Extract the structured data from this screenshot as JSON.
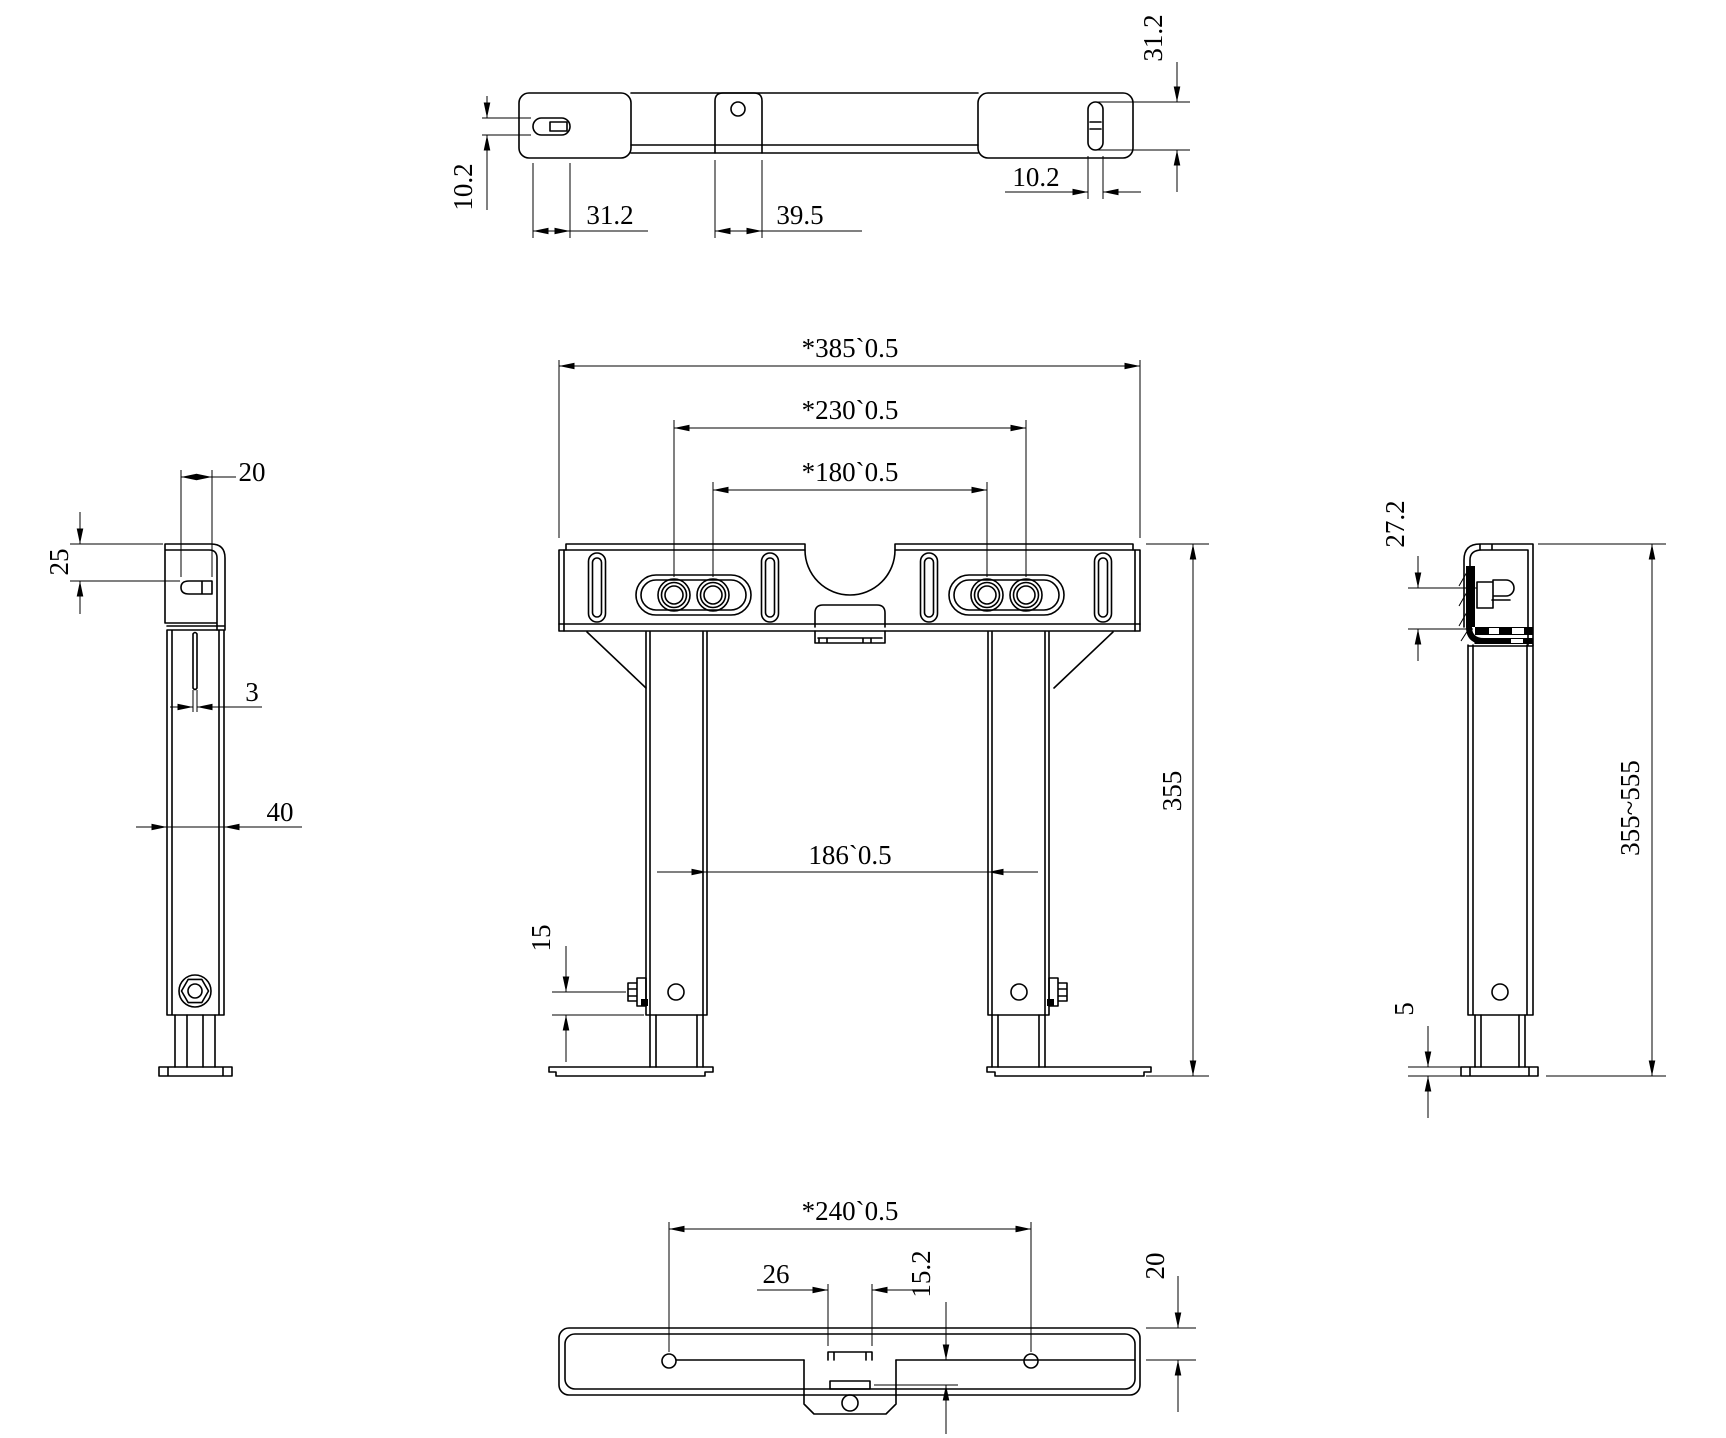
{
  "meta": {
    "background": "#ffffff",
    "line_color": "#000000"
  },
  "views": {
    "top": {
      "dims": {
        "slot_height_left": "10.2",
        "slot_length_left": "31.2",
        "tab_width": "39.5",
        "slot_width_right": "10.2",
        "slot_length_right": "31.2"
      }
    },
    "front": {
      "dims": {
        "overall_width": "*385`0.5",
        "hole_span_outer": "*230`0.5",
        "hole_span_inner": "*180`0.5",
        "leg_gap": "186`0.5",
        "bolt_offset": "15",
        "height": "355"
      }
    },
    "left": {
      "dims": {
        "slot_length": "20",
        "slot_offset": "25",
        "slot_width": "3",
        "leg_width": "40"
      }
    },
    "right": {
      "dims": {
        "bracket_depth": "27.2",
        "height_range": "355~555",
        "foot_thickness": "5"
      }
    },
    "bottom": {
      "dims": {
        "hole_span": "*240`0.5",
        "tab_width": "26",
        "tab_depth": "15.2",
        "bar_depth": "20"
      }
    }
  }
}
